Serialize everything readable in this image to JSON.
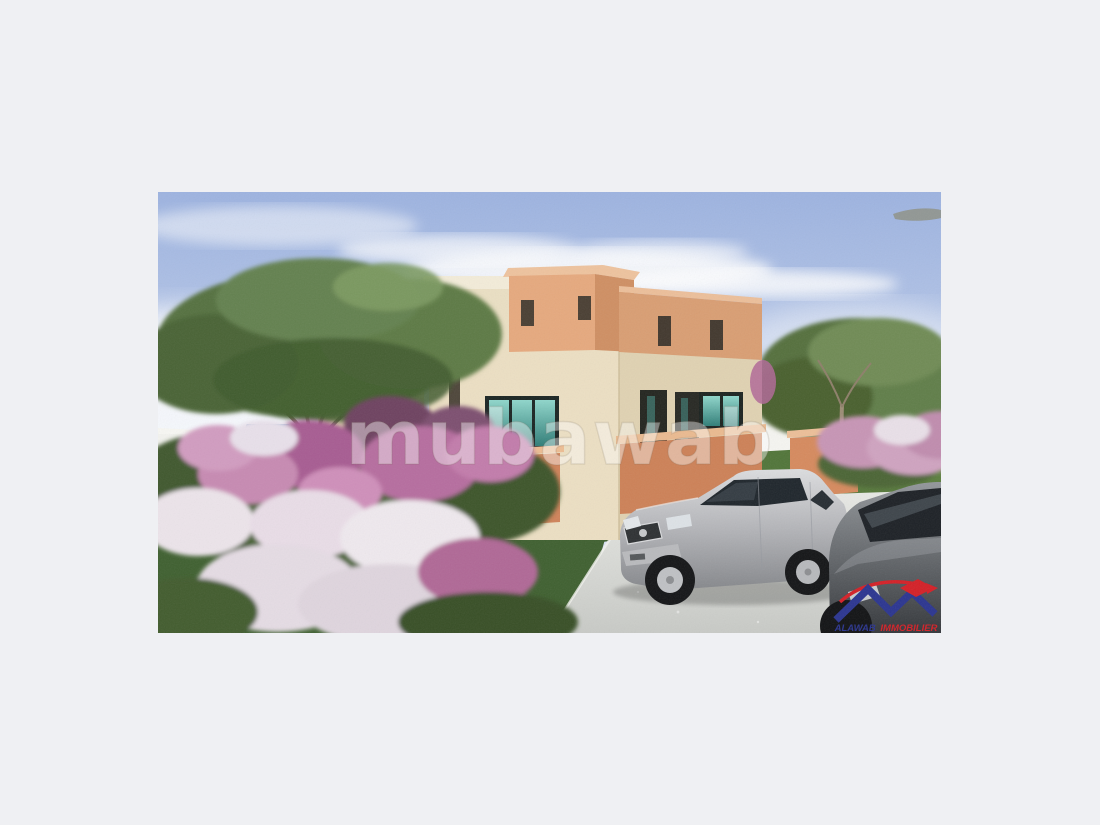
{
  "page": {
    "background": "#eff0f3"
  },
  "image": {
    "kind": "real-estate-listing-photo",
    "alt": "3D architectural rendering of a modern two-storey beige villa with a terracotta upper volume and orange garden walls, surrounded by green trees, pink and white flowering shrubs and lawn; a silver sedan and a second grey car are parked on a light concrete driveway under a blue sky with wispy clouds.",
    "watermark": {
      "text": "mubawab",
      "color": "#ffffff",
      "opacity": 0.42
    },
    "logo": {
      "name_blue": "ALAWAB",
      "name_red": "IMMOBILIER",
      "blue_color": "#2b3590",
      "red_color": "#d42027"
    },
    "palette": {
      "sky_top": "#9db3e0",
      "sky_bottom": "#e8eef7",
      "cloud": "#ffffff",
      "house_beige": "#ecdfc3",
      "house_beige_shade": "#e0d2b2",
      "terracotta": "#e0a077",
      "garden_wall_orange": "#d0835a",
      "window_glass_teal": "#4fa39b",
      "window_frame": "#1b2523",
      "grass": "#567c3e",
      "tree_foliage": "#55713f",
      "flower_pink": "#c77fae",
      "flower_white": "#ece4ea",
      "driveway": "#d9dad6",
      "car_silver": "#b9babd",
      "car_dark": "#55585c",
      "perimeter_wall": "#f5f5f1"
    }
  }
}
